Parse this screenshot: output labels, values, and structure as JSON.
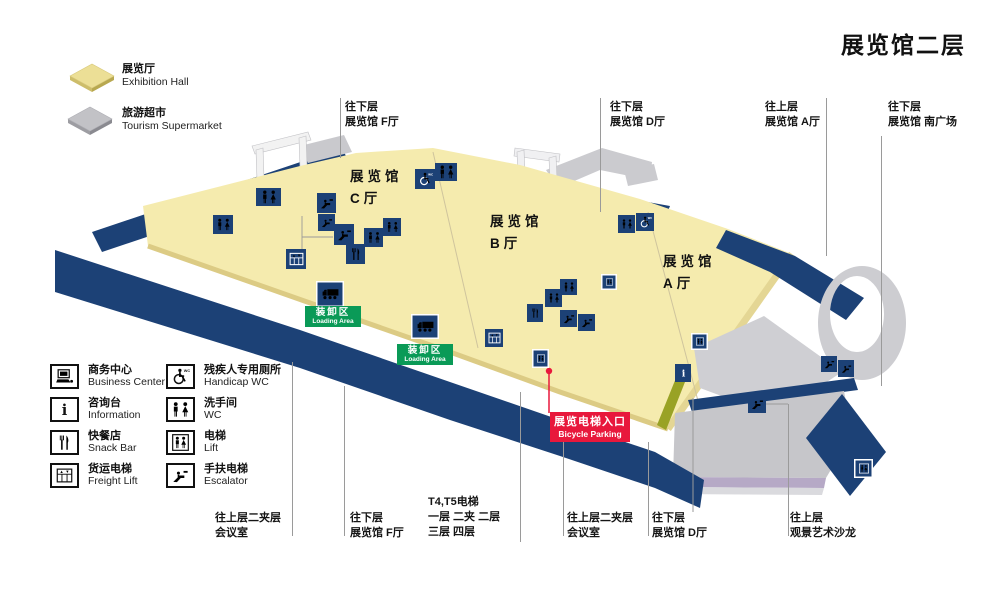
{
  "title": "展览馆二层",
  "colors": {
    "navy": "#1c4176",
    "floor_yellow": "#f5ebae",
    "structure_gray": "#c9c9cd",
    "loading_green": "#0a9a57",
    "entrance_red": "#e8183c",
    "hairline": "#9a9a9a"
  },
  "legend_top": {
    "items": [
      {
        "name": "exhibition-hall",
        "zh": "展览厅",
        "en": "Exhibition Hall",
        "color": "#ecdf96"
      },
      {
        "name": "tourism-supermarket",
        "zh": "旅游超市",
        "en": "Tourism Supermarket",
        "color": "#c2c2c6"
      }
    ]
  },
  "legend_bottom": {
    "columns": [
      [
        {
          "icon": "business-center-icon",
          "sym": "computer",
          "zh": "商务中心",
          "en": "Business Center"
        },
        {
          "icon": "information-icon",
          "sym": "info",
          "zh": "咨询台",
          "en": "Information"
        },
        {
          "icon": "snack-bar-icon",
          "sym": "snack",
          "zh": "快餐店",
          "en": "Snack Bar"
        },
        {
          "icon": "freight-lift-icon",
          "sym": "freight",
          "zh": "货运电梯",
          "en": "Freight Lift"
        }
      ],
      [
        {
          "icon": "handicap-wc-icon",
          "sym": "handicap",
          "zh": "残疾人专用厕所",
          "en": "Handicap WC"
        },
        {
          "icon": "wc-icon",
          "sym": "wc",
          "zh": "洗手间",
          "en": "WC"
        },
        {
          "icon": "lift-icon",
          "sym": "lift",
          "zh": "电梯",
          "en": "Lift"
        },
        {
          "icon": "escalator-icon",
          "sym": "esc",
          "zh": "手扶电梯",
          "en": "Escalator"
        }
      ]
    ]
  },
  "map": {
    "halls": [
      {
        "zh": "展览馆",
        "hall": "C厅",
        "x": 350,
        "y": 166
      },
      {
        "zh": "展览馆",
        "hall": "B厅",
        "x": 490,
        "y": 211
      },
      {
        "zh": "展览馆",
        "hall": "A厅",
        "x": 663,
        "y": 251
      }
    ],
    "loading_areas": [
      {
        "zh": "装卸区",
        "en": "Loading Area",
        "x": 305,
        "y": 306
      },
      {
        "zh": "装卸区",
        "en": "Loading Area",
        "x": 397,
        "y": 344
      }
    ],
    "entrance_label": {
      "zh": "展览电梯入口",
      "en": "Bicycle Parking",
      "x": 550,
      "y": 412
    },
    "top_labels": [
      {
        "lines": [
          "往下层",
          "展览馆 F厅"
        ],
        "x": 345,
        "y": 100,
        "line_x": 340,
        "line_y1": 98,
        "line_y2": 158
      },
      {
        "lines": [
          "往下层",
          "展览馆 D厅"
        ],
        "x": 610,
        "y": 100,
        "line_x": 600,
        "line_y1": 98,
        "line_y2": 212
      },
      {
        "lines": [
          "往上层",
          "展览馆 A厅"
        ],
        "x": 765,
        "y": 100,
        "line_x": 826,
        "line_y1": 98,
        "line_y2": 256
      },
      {
        "lines": [
          "往下层",
          "展览馆 南广场"
        ],
        "x": 888,
        "y": 100,
        "line_x": 881,
        "line_y1": 136,
        "line_y2": 386
      }
    ],
    "bottom_labels": [
      {
        "lines": [
          "往上层二夹层",
          "会议室"
        ],
        "x": 215,
        "y": 511,
        "line_x": 292,
        "line_y1": 362,
        "line_y2": 536
      },
      {
        "lines": [
          "往下层",
          "展览馆 F厅"
        ],
        "x": 350,
        "y": 511,
        "line_x": 344,
        "line_y1": 386,
        "line_y2": 536
      },
      {
        "lines": [
          "T4,T5电梯",
          "一层  二夹  二层",
          "三层  四层"
        ],
        "x": 428,
        "y": 495,
        "line_x": 520,
        "line_y1": 392,
        "line_y2": 542
      },
      {
        "lines": [
          "往上层二夹层",
          "会议室"
        ],
        "x": 567,
        "y": 511,
        "line_x": 563,
        "line_y1": 432,
        "line_y2": 536
      },
      {
        "lines": [
          "往下层",
          "展览馆 D厅"
        ],
        "x": 652,
        "y": 511,
        "line_x": 648,
        "line_y1": 442,
        "line_y2": 536
      },
      {
        "lines": [
          "往上层",
          "观景艺术沙龙"
        ],
        "x": 790,
        "y": 511,
        "line_x": 788,
        "line_y1": 404,
        "line_y2": 536
      }
    ],
    "icons": [
      {
        "t": "wc",
        "x": 256,
        "y": 188,
        "w": 25,
        "h": 18
      },
      {
        "t": "wc",
        "x": 213,
        "y": 215,
        "w": 20,
        "h": 19
      },
      {
        "t": "esc",
        "x": 317,
        "y": 193,
        "w": 19,
        "h": 20
      },
      {
        "t": "esc",
        "x": 318,
        "y": 214,
        "w": 17,
        "h": 17
      },
      {
        "t": "esc",
        "x": 334,
        "y": 224,
        "w": 20,
        "h": 21
      },
      {
        "t": "wc",
        "x": 364,
        "y": 228,
        "w": 19,
        "h": 19
      },
      {
        "t": "wc",
        "x": 383,
        "y": 218,
        "w": 18,
        "h": 18
      },
      {
        "t": "snack",
        "x": 346,
        "y": 244,
        "w": 19,
        "h": 20
      },
      {
        "t": "freight",
        "x": 286,
        "y": 249,
        "w": 20,
        "h": 20
      },
      {
        "t": "handicap",
        "x": 415,
        "y": 169,
        "w": 20,
        "h": 20
      },
      {
        "t": "wc",
        "x": 435,
        "y": 163,
        "w": 22,
        "h": 18
      },
      {
        "t": "truck",
        "x": 316,
        "y": 281,
        "w": 28,
        "h": 26
      },
      {
        "t": "truck",
        "x": 411,
        "y": 314,
        "w": 28,
        "h": 25
      },
      {
        "t": "freight",
        "x": 485,
        "y": 329,
        "w": 18,
        "h": 18
      },
      {
        "t": "lift",
        "x": 601,
        "y": 274,
        "w": 16,
        "h": 16
      },
      {
        "t": "wc",
        "x": 560,
        "y": 279,
        "w": 17,
        "h": 16
      },
      {
        "t": "wc",
        "x": 545,
        "y": 289,
        "w": 17,
        "h": 18
      },
      {
        "t": "snack",
        "x": 527,
        "y": 304,
        "w": 16,
        "h": 18
      },
      {
        "t": "esc",
        "x": 560,
        "y": 310,
        "w": 17,
        "h": 17
      },
      {
        "t": "esc",
        "x": 578,
        "y": 314,
        "w": 17,
        "h": 17
      },
      {
        "t": "wc",
        "x": 618,
        "y": 215,
        "w": 17,
        "h": 18
      },
      {
        "t": "handicap",
        "x": 636,
        "y": 213,
        "w": 18,
        "h": 18
      },
      {
        "t": "lift",
        "x": 532,
        "y": 349,
        "w": 17,
        "h": 19
      },
      {
        "t": "lift",
        "x": 691,
        "y": 333,
        "w": 17,
        "h": 17
      },
      {
        "t": "info",
        "x": 675,
        "y": 364,
        "w": 16,
        "h": 18
      },
      {
        "t": "esc",
        "x": 821,
        "y": 356,
        "w": 16,
        "h": 16
      },
      {
        "t": "esc",
        "x": 838,
        "y": 360,
        "w": 16,
        "h": 17
      },
      {
        "t": "esc",
        "x": 748,
        "y": 395,
        "w": 18,
        "h": 18
      },
      {
        "t": "lift",
        "x": 854,
        "y": 459,
        "w": 19,
        "h": 19
      }
    ]
  }
}
